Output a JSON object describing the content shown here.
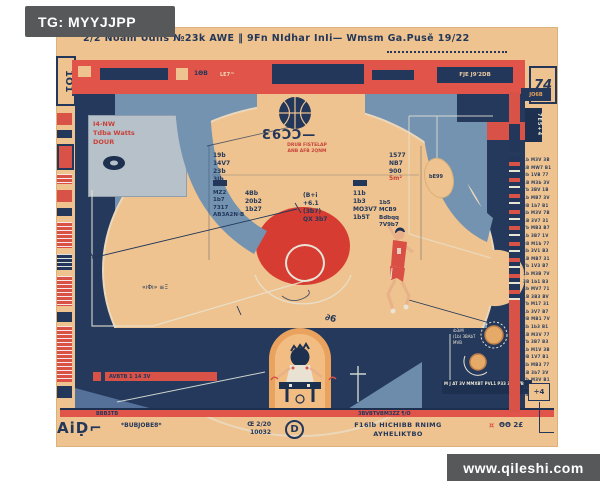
{
  "watermark": {
    "tag": "TG: MYYJJPP",
    "site": "www.qileshi.com"
  },
  "poster": {
    "headline": "2/2 Noam Udils  №23k  AWE ‖ 9Fn NIdhar  InIi—  Wmsm  Ga.Pusĕ 19/22",
    "left_code": "1O1",
    "band": {
      "label_a": "1ΘB",
      "label_b": "LE7™",
      "label_d": "FJE J9'2DB"
    },
    "panel_text": "I4·NW\nTdba Watts\nDOUR",
    "badge": {
      "label": "Ɛ6ϽϽ—",
      "sub": "DRUB FISTELAP\nANB AFB 2QNM"
    },
    "stats": {
      "a": "19b\n14V7\n23b\n3Jb",
      "c": "MZ2\n1b7\n7317\nAB3A2N·B",
      "b": "4Bb\n20b2\n1b27",
      "d": "(B+i\n+6.1\n(3b7)\nQX 3b7",
      "e": "11b\n1b3\nMO3V7\n1b5T",
      "f": "1577\nNB7\n900",
      "f_red": "5m²",
      "g": "1b5\nMCB9\nBdbqq\n7V9b7",
      "scribble": "«ıΦı» ≡Ξ",
      "note": "∂6"
    },
    "right_panel_tag": "bE99",
    "rings_label": "ıb3ıM\n(1b) ЗВАbТ\nMVB",
    "bottom": {
      "red_note": "AVBTB 1 14 3V",
      "navy_note": "M J AT 3V MMXBT PVL1 P33 3VLLVB"
    },
    "rule": {
      "left": "BBB3TB",
      "right": "3BVBTVBM3ZZ  ¶/O"
    },
    "footer": {
      "big": "AiḌ⌐",
      "small": "*BUBJOBE8*",
      "code": "Œ 2/20\n10032",
      "d_mark": "D",
      "center": "F16lb HICHIBB RNIMG\nAYHELIKTBO",
      "right_red": "¤",
      "right_navy": "ΘΘ 2£"
    },
    "side": {
      "code": "74",
      "tag": "JO6B",
      "tab": "7E5+4",
      "plus_box": "÷4",
      "list": "1b M3V 3B\n4B MW7 B1\n3b 1VB 77\n1B M3b 3V\n7b 3BV 1B\n1b MB7 3V\n3B 1b7 B1\n4b M3V 7B\n1B 3V7 31\n7b MB3 B7\n1b 3B7 1V\n3B M1b 77\n4b 3V1 B3\n1B MB7 31\n7b 1V3 B7\n1b M3B 7V\n3B 1b1 B3\n4b MV7 71\n1B 3B3 BV\n7b M17 31\n1b 3V7 B7\n3B MB1 7V\n4b 1b3 B1\n1B M3V 77\n7b 3B7 B3\n1b M1V 3B\n3B 1V7 B1\n4b MB3 77\n1B 3b7 3V\n7b M3V B1\n1b 1B7 7V\n3B MV3 B3"
    }
  }
}
